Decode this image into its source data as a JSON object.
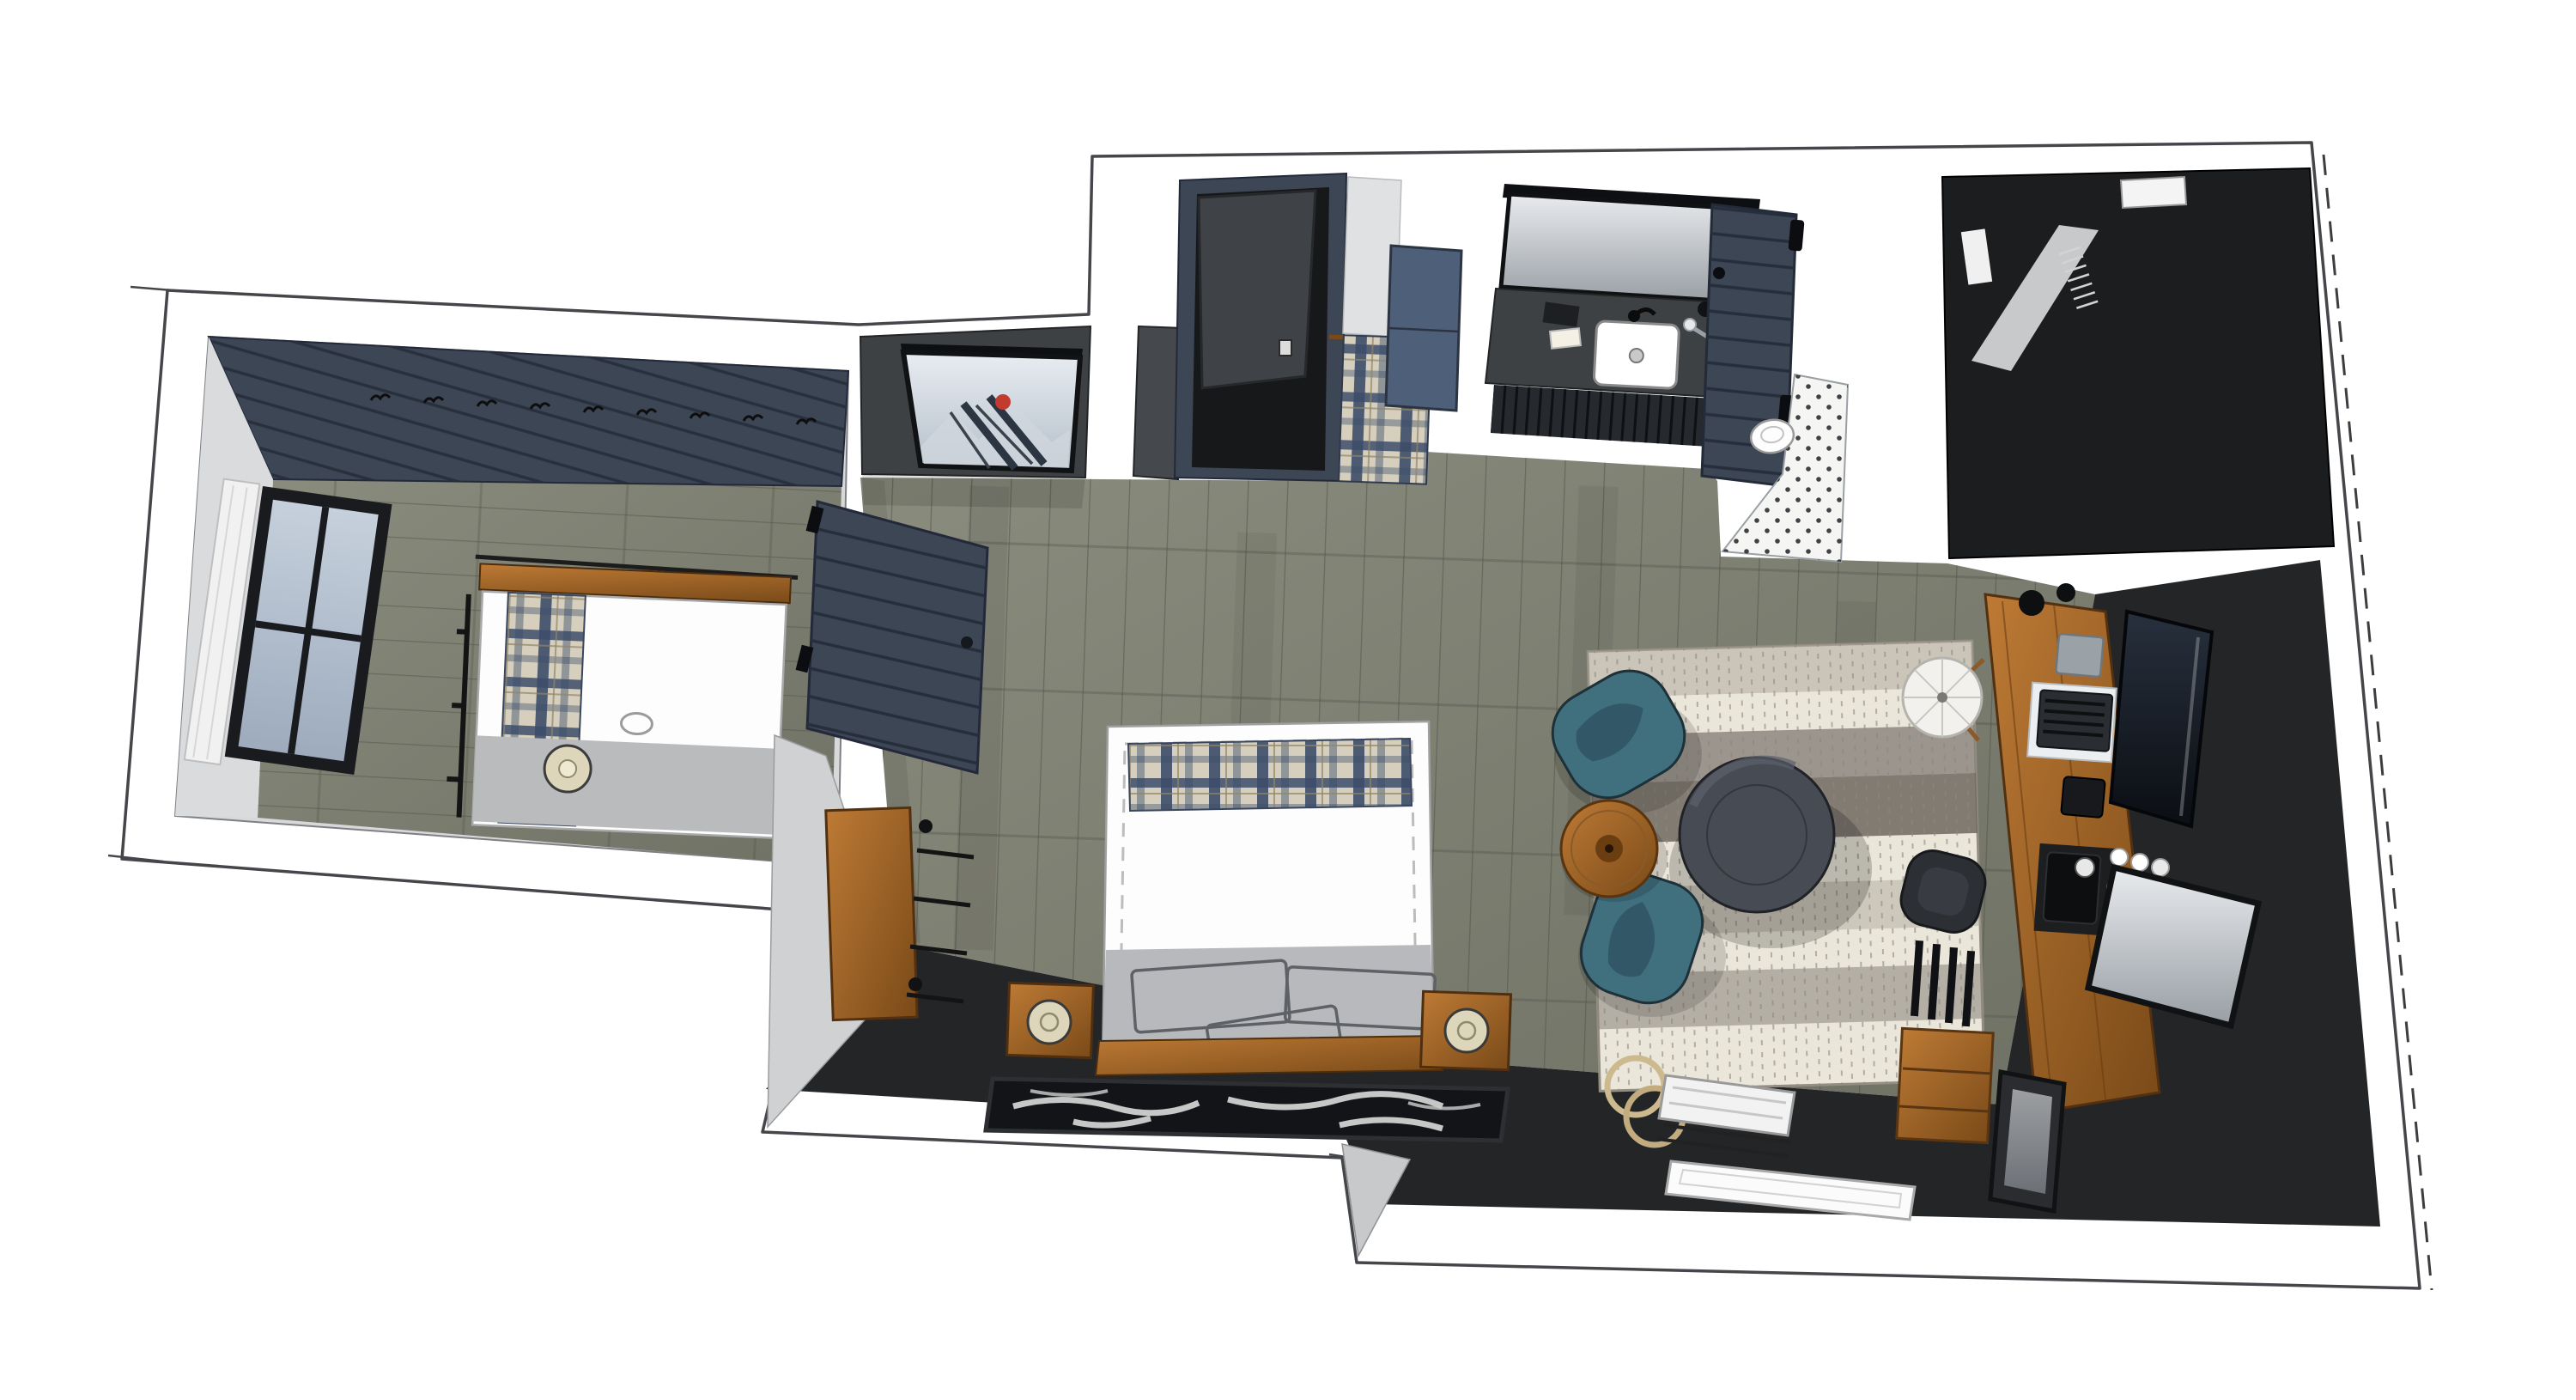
{
  "meta": {
    "title": "Overhead 3D rendering of a studio suite floor plan (no visible text in image)",
    "render_style": "sketchup-style top-down dollhouse view"
  },
  "palette": {
    "paper": "#ffffff",
    "line": "#45464a",
    "wall-gray": "#d6d8da",
    "wall-gray-2": "#c6c8cb",
    "navy": "#3d4654",
    "navy-dark": "#262d3b",
    "slate-blue": "#4e5f7a",
    "charcoal": "#3e4144",
    "charcoal-dark": "#232527",
    "near-black": "#18191b",
    "floor-a": "#8a8c7e",
    "floor-b": "#6f7164",
    "plank": "#51544a",
    "wood": "#aa6a2c",
    "wood-dark": "#7a4a18",
    "teal": "#406f7e",
    "teal-dark": "#2e5361",
    "rug-cream": "#eae6da",
    "rug-taupe": "#b0a99e",
    "rug-gray": "#87817a",
    "ottoman": "#474c54",
    "plaid-base": "#d6cfbd",
    "plaid-navy": "#3d4e6a",
    "glass": "#b9c4d6",
    "mirror-a": "#e9ebee",
    "mirror-b": "#989ea4",
    "lamp-cream": "#ddd6ba",
    "tile-white": "#f5f5f3",
    "cowhide": "#131417",
    "accent-red": "#c23b2e",
    "snow-a": "#e8edf2",
    "snow-b": "#b4bec9",
    "tv-a": "#27303d",
    "tv-b": "#0b0e13"
  },
  "scene": {
    "rooms": [
      {
        "name": "bunk-room",
        "objects": [
          "shiplap-accent-wall-with-coat-hooks",
          "window-with-white-curtain",
          "single-bed-white-duvet",
          "plaid-runner",
          "gray-foot-blanket",
          "wood-headboard",
          "table-lamp",
          "bed-rail-ladder"
        ]
      },
      {
        "name": "entry",
        "objects": [
          "open-entry-door",
          "navy-door-frame",
          "towel-rod-with-plaid-towels",
          "slate-blue-wall-cabinet"
        ]
      },
      {
        "name": "bathroom",
        "objects": [
          "vanity-mirror",
          "charcoal-vanity-counter",
          "white-undermount-sink",
          "black-faucet",
          "soap-and-amenities",
          "slatted-vanity-front",
          "navy-shiplap-barn-door",
          "penny-tile-shower-floor",
          "toilet"
        ]
      },
      {
        "name": "closet",
        "objects": [
          "dark-closet-walls",
          "closet-shelf",
          "hanging-rod-with-hangers",
          "white-storage-box"
        ]
      },
      {
        "name": "main-bedroom",
        "objects": [
          "framed-ski-poster",
          "charcoal-accent-wall",
          "navy-sliding-barn-door",
          "rustic-wood-console",
          "king-bed-white-duvet",
          "plaid-band",
          "sketched-pillows",
          "wood-headboard",
          "cowhide-runner-rug",
          "nightstand-left",
          "nightstand-right",
          "cream-table-lamps"
        ]
      },
      {
        "name": "living-work-area",
        "objects": [
          "striped-area-rug",
          "round-charcoal-ottoman",
          "teal-swivel-chair-north",
          "teal-swivel-chair-south",
          "round-wood-side-table",
          "tripod-floor-lamp",
          "live-edge-wood-desk",
          "desk-chair",
          "laptop-and-keyboard",
          "desk-phone",
          "tissue-box",
          "coffee-station",
          "white-mugs",
          "wall-mounted-tv",
          "leaning-mirror",
          "dark-leaning-frame",
          "wood-bookcase",
          "luggage-rack-with-suitcase",
          "white-tray"
        ]
      }
    ]
  }
}
